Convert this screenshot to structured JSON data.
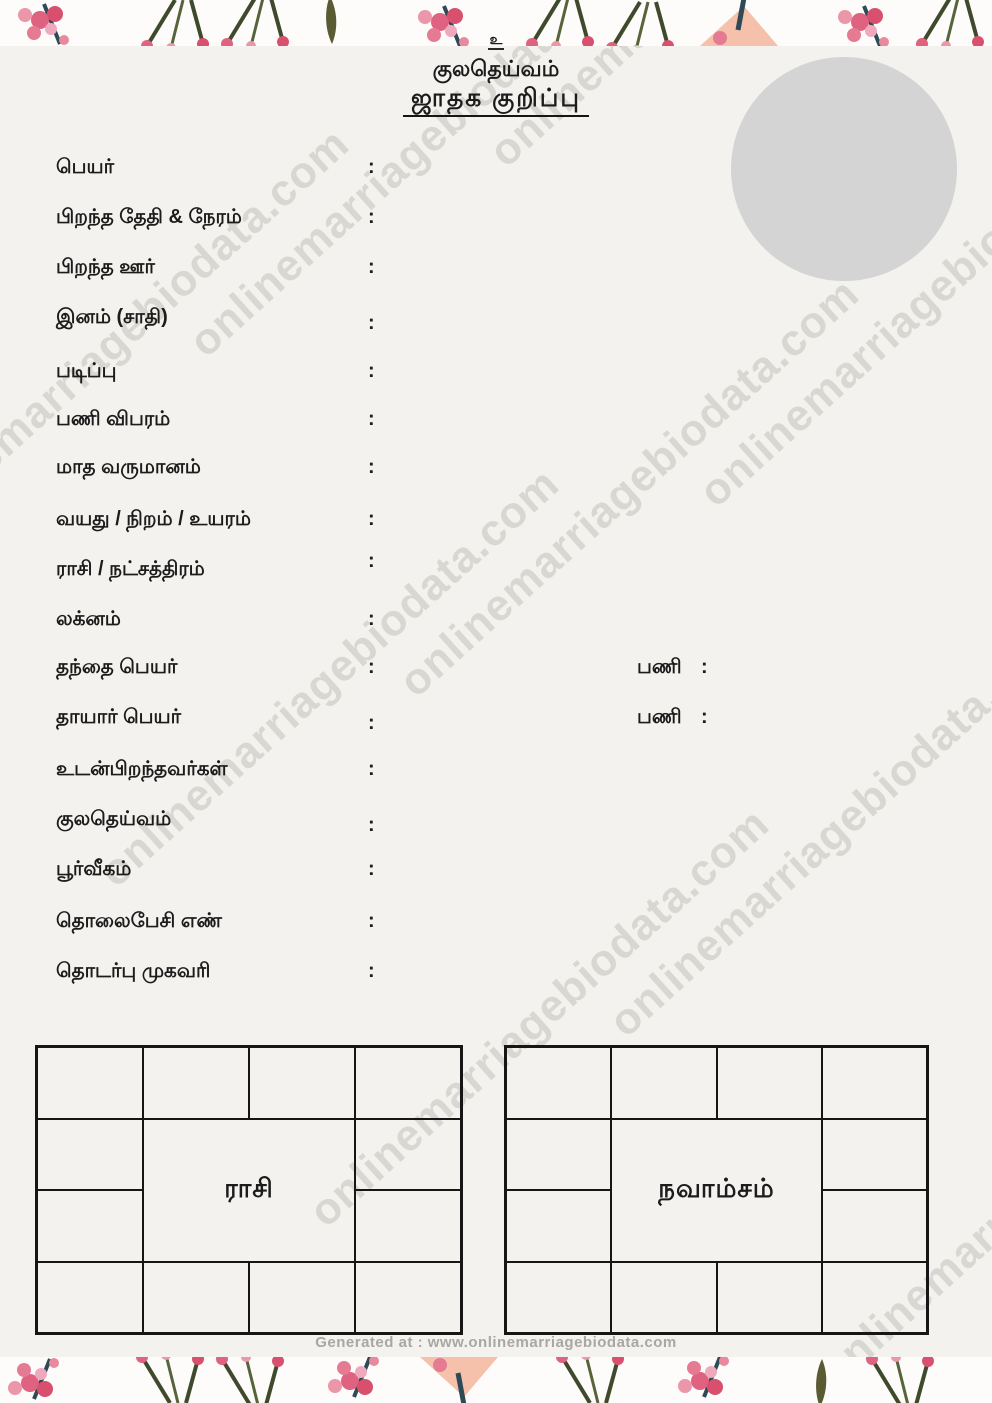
{
  "header": {
    "invocation": "உ",
    "deity_line": "குலதெய்வம்",
    "title": "ஜாதக குறிப்பு"
  },
  "photo": {
    "placeholder_color": "#d4d4d4"
  },
  "fields": [
    {
      "label": "பெயர்",
      "separator": ":",
      "value": ""
    },
    {
      "label": "பிறந்த தேதி & நேரம்",
      "separator": ":",
      "value": ""
    },
    {
      "label": "பிறந்த ஊர்",
      "separator": ":",
      "value": ""
    },
    {
      "label": "இனம் (சாதி)",
      "separator": ":",
      "value": ""
    },
    {
      "label": "படிப்பு",
      "separator": ":",
      "value": ""
    },
    {
      "label": "பணி விபரம்",
      "separator": ":",
      "value": ""
    },
    {
      "label": "மாத வருமானம்",
      "separator": ":",
      "value": ""
    },
    {
      "label": "வயது / நிறம் / உயரம்",
      "separator": ":",
      "value": ""
    },
    {
      "label": "ராசி / நட்சத்திரம்",
      "separator": ":",
      "value": ""
    },
    {
      "label": "லக்னம்",
      "separator": ":",
      "value": ""
    },
    {
      "label": "தந்தை பெயர்",
      "separator": ":",
      "value": "",
      "extra_label": "பணி",
      "extra_separator": ":",
      "extra_value": ""
    },
    {
      "label": "தாயார் பெயர்",
      "separator": ":",
      "value": "",
      "extra_label": "பணி",
      "extra_separator": ":",
      "extra_value": ""
    },
    {
      "label": "உடன்பிறந்தவர்கள்",
      "separator": ":",
      "value": ""
    },
    {
      "label": "குலதெய்வம்",
      "separator": ":",
      "value": ""
    },
    {
      "label": "பூர்வீகம்",
      "separator": ":",
      "value": ""
    },
    {
      "label": "தொலைபேசி எண்",
      "separator": ":",
      "value": ""
    },
    {
      "label": "தொடர்பு முகவரி",
      "separator": ":",
      "value": ""
    }
  ],
  "charts": [
    {
      "title": "ராசி"
    },
    {
      "title": "நவாம்சம்"
    }
  ],
  "watermark": {
    "text": "onlinemarriagebiodata.com",
    "color": "#d8d6d2"
  },
  "footer": {
    "text": "Generated at : www.onlinemarriagebiodata.com"
  },
  "colors": {
    "page_background": "#f3f2ef",
    "text": "#1c1c1c",
    "photo_placeholder": "#d4d4d4",
    "floral_pink": "#df6280",
    "floral_pink_light": "#ec96a9",
    "floral_stem_green": "#3f4a2c",
    "floral_teal": "#2e4a56",
    "floral_peach": "#f2b197",
    "footer_text": "#a9a7a3"
  }
}
